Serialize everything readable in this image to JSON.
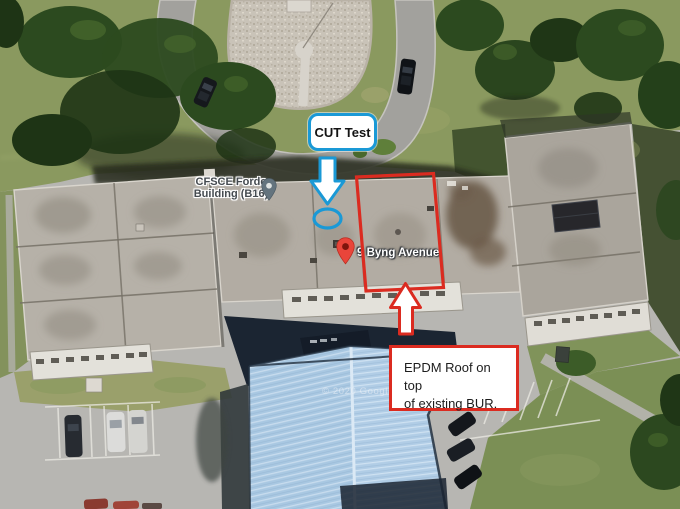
{
  "map": {
    "watermark": "© 2020 Google",
    "poi_label": {
      "line1": "CFSCE Forde",
      "line2": "Building (B16)"
    },
    "address_label": "9 Byng Avenue",
    "icons": {
      "building_pin": "map-pin",
      "address_pin": "map-pin"
    }
  },
  "annotations": {
    "cut_test_label": "CUT Test",
    "epdm_note": {
      "line1": "EPDM Roof on top",
      "line2": "of existing BUR."
    },
    "icons": {
      "blue_arrow": "arrow-down",
      "red_arrow": "arrow-up",
      "cut_marker": "ellipse-outline",
      "epdm_area": "rectangle-outline"
    },
    "colors": {
      "blue": "#1a99d6",
      "red": "#db2b20"
    }
  }
}
